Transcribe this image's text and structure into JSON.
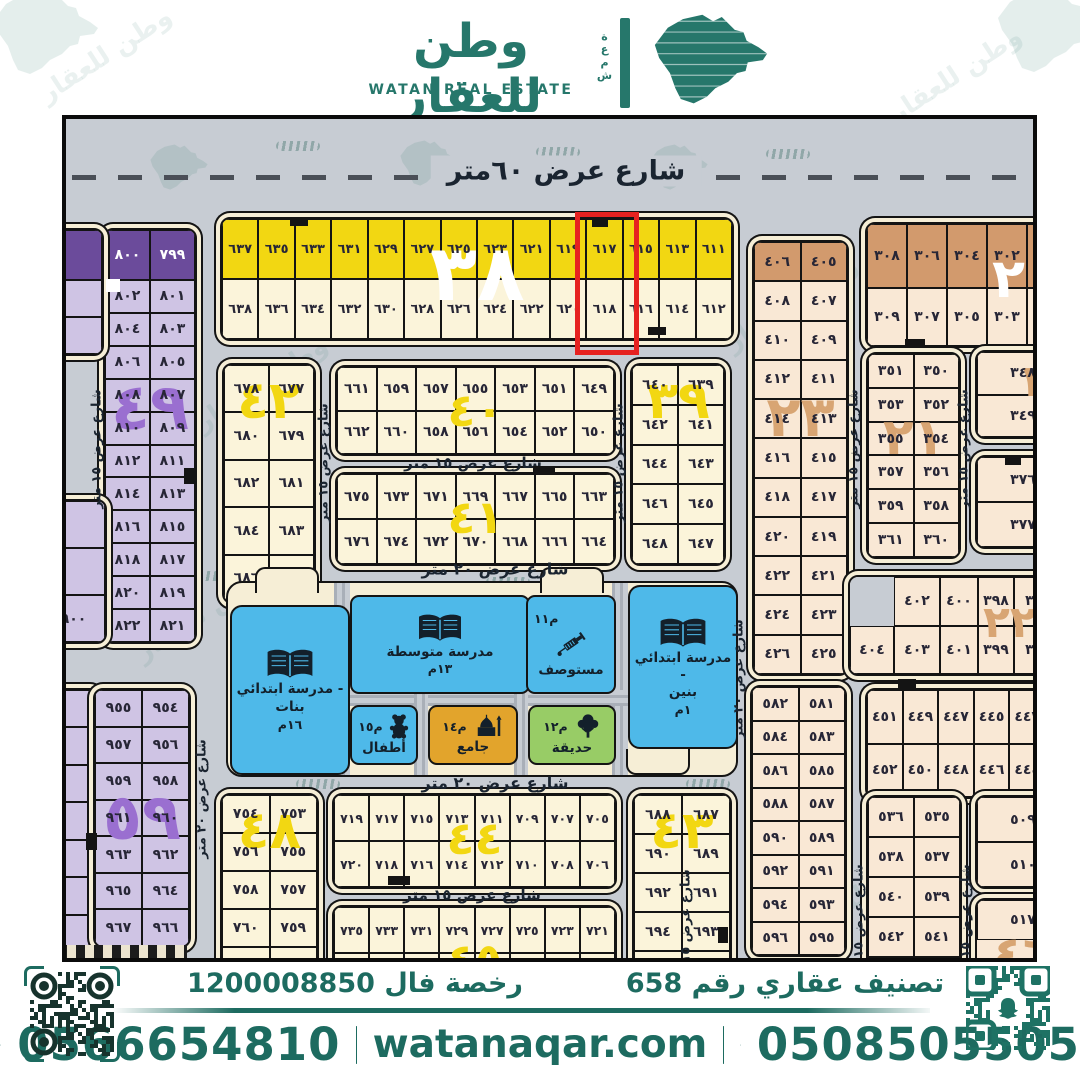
{
  "brand": {
    "name_ar": "وطن للعقار",
    "name_en": "WATAN REAL ESTATE",
    "side_ar": "شمعة",
    "watermark": "وطن للعقار",
    "accent": "#1d6b60"
  },
  "map": {
    "streets": {
      "sixty": "شارع عرض ٦٠متر",
      "twenty": "شارع عرض ٢٠ متر",
      "fifteen": "شارع عرض ١٥ متر"
    },
    "highlight_plots": [
      "٦١٧",
      "٦١٨"
    ],
    "highlight_color": "#e62220",
    "blocks": {
      "b38": {
        "num": "٣٨",
        "rows": [
          [
            "٦٣٧",
            "٦٣٥",
            "٦٣٣",
            "٦٣١",
            "٦٢٩",
            "٦٢٧",
            "٦٢٥",
            "٦٢٣",
            "٦٢١",
            "٦١٩",
            "٦١٧",
            "٦١٥",
            "٦١٣",
            "٦١١"
          ],
          [
            "٦٣٨",
            "٦٣٦",
            "٦٣٤",
            "٦٣٢",
            "٦٣٠",
            "٦٢٨",
            "٦٢٦",
            "٦٢٤",
            "٦٢٢",
            "٦٢٠",
            "٦١٨",
            "٦١٦",
            "٦١٤",
            "٦١٢"
          ]
        ]
      },
      "btr": {
        "num": "٢٠",
        "rows": [
          [
            "٣٠٨",
            "٣٠٦",
            "٣٠٤",
            "٣٠٢",
            "٣٠٠"
          ],
          [
            "٣٠٩",
            "٣٠٧",
            "٣٠٥",
            "٣٠٣",
            "٣٠١"
          ]
        ]
      },
      "b49": {
        "num": "٤٩",
        "rows": [
          [
            "٨٠٠",
            "٧٩٩"
          ],
          [
            "٨٠٢",
            "٨٠١"
          ],
          [
            "٨٠٤",
            "٨٠٣"
          ],
          [
            "٨٠٦",
            "٨٠٥"
          ],
          [
            "٨٠٨",
            "٨٠٧"
          ],
          [
            "٨١٠",
            "٨٠٩"
          ],
          [
            "٨١٢",
            "٨١١"
          ],
          [
            "٨١٤",
            "٨١٣"
          ],
          [
            "٨١٦",
            "٨١٥"
          ],
          [
            "٨١٨",
            "٨١٧"
          ],
          [
            "٨٢٠",
            "٨١٩"
          ],
          [
            "٨٢٢",
            "٨٢١"
          ]
        ]
      },
      "s1": {
        "rows": [
          [
            ""
          ],
          [
            ""
          ],
          [
            ""
          ]
        ]
      },
      "s2": {
        "rows": [
          [
            ""
          ],
          [
            ""
          ],
          [
            "٩٠٠"
          ]
        ]
      },
      "s3": {
        "rows": [
          [
            ""
          ],
          [
            ""
          ],
          [
            ""
          ],
          [
            ""
          ],
          [
            ""
          ],
          [
            ""
          ],
          [
            ""
          ]
        ]
      },
      "b42": {
        "num": "٤٢",
        "rows": [
          [
            "٦٧٨",
            "٦٧٧"
          ],
          [
            "٦٨٠",
            "٦٧٩"
          ],
          [
            "٦٨٢",
            "٦٨١"
          ],
          [
            "٦٨٤",
            "٦٨٣"
          ],
          [
            "٦٨٦",
            "٦٨٥"
          ]
        ]
      },
      "b40": {
        "num": "٤٠",
        "rows": [
          [
            "٦٦١",
            "٦٥٩",
            "٦٥٧",
            "٦٥٥",
            "٦٥٣",
            "٦٥١",
            "٦٤٩"
          ],
          [
            "٦٦٢",
            "٦٦٠",
            "٦٥٨",
            "٦٥٦",
            "٦٥٤",
            "٦٥٢",
            "٦٥٠"
          ]
        ]
      },
      "b41": {
        "num": "٤١",
        "rows": [
          [
            "٦٧٥",
            "٦٧٣",
            "٦٧١",
            "٦٦٩",
            "٦٦٧",
            "٦٦٥",
            "٦٦٣"
          ],
          [
            "٦٧٦",
            "٦٧٤",
            "٦٧٢",
            "٦٧٠",
            "٦٦٨",
            "٦٦٦",
            "٦٦٤"
          ]
        ]
      },
      "b39": {
        "num": "٣٩",
        "rows": [
          [
            "٦٤٠",
            "٦٣٩"
          ],
          [
            "٦٤٢",
            "٦٤١"
          ],
          [
            "٦٤٤",
            "٦٤٣"
          ],
          [
            "٦٤٦",
            "٦٤٥"
          ],
          [
            "٦٤٨",
            "٦٤٧"
          ]
        ]
      },
      "b23": {
        "num": "٢٣",
        "rows": [
          [
            "٤٠٦",
            "٤٠٥"
          ],
          [
            "٤٠٨",
            "٤٠٧"
          ],
          [
            "٤١٠",
            "٤٠٩"
          ],
          [
            "٤١٢",
            "٤١١"
          ],
          [
            "٤١٤",
            "٤١٣"
          ],
          [
            "٤١٦",
            "٤١٥"
          ],
          [
            "٤١٨",
            "٤١٧"
          ],
          [
            "٤٢٠",
            "٤١٩"
          ],
          [
            "٤٢٢",
            "٤٢١"
          ],
          [
            "٤٢٤",
            "٤٢٣"
          ],
          [
            "٤٢٦",
            "٤٢٥"
          ]
        ]
      },
      "b21": {
        "num": "٢١",
        "rows": [
          [
            "٣٥١",
            "٣٥٠"
          ],
          [
            "٣٥٣",
            "٣٥٢"
          ],
          [
            "٣٥٥",
            "٣٥٤"
          ],
          [
            "٣٥٧",
            "٣٥٦"
          ],
          [
            "٣٥٩",
            "٣٥٨"
          ],
          [
            "٣٦١",
            "٣٦٠"
          ]
        ]
      },
      "b19": {
        "num": "١٩",
        "rows": [
          [
            "٣٤٨"
          ],
          [
            "٣٤٩"
          ]
        ]
      },
      "b376": {
        "rows": [
          [
            "٣٧٦"
          ],
          [
            "٣٧٧"
          ]
        ]
      },
      "b22": {
        "num": "٢٢",
        "rows": [
          [
            null,
            "٤٠٢",
            "٤٠٠",
            "٣٩٨",
            "٣٩٦"
          ],
          [
            "٤٠٤",
            "٤٠٣",
            "٤٠١",
            "٣٩٩",
            "٣٩٧"
          ]
        ]
      },
      "b59": {
        "num": "٥٩",
        "rows": [
          [
            "٩٥٥",
            "٩٥٤"
          ],
          [
            "٩٥٧",
            "٩٥٦"
          ],
          [
            "٩٥٩",
            "٩٥٨"
          ],
          [
            "٩٦١",
            "٩٦٠"
          ],
          [
            "٩٦٣",
            "٩٦٢"
          ],
          [
            "٩٦٥",
            "٩٦٤"
          ],
          [
            "٩٦٧",
            "٩٦٦"
          ]
        ]
      },
      "b48": {
        "num": "٤٨",
        "rows": [
          [
            "٧٥٤",
            "٧٥٣"
          ],
          [
            "٧٥٦",
            "٧٥٥"
          ],
          [
            "٧٥٨",
            "٧٥٧"
          ],
          [
            "٧٦٠",
            "٧٥٩"
          ],
          [
            "",
            ""
          ]
        ]
      },
      "b44": {
        "num": "٤٤",
        "rows": [
          [
            "٧١٩",
            "٧١٧",
            "٧١٥",
            "٧١٣",
            "٧١١",
            "٧٠٩",
            "٧٠٧",
            "٧٠٥"
          ],
          [
            "٧٢٠",
            "٧١٨",
            "٧١٦",
            "٧١٤",
            "٧١٢",
            "٧١٠",
            "٧٠٨",
            "٧٠٦"
          ]
        ]
      },
      "b45": {
        "num": "٤٥",
        "rows": [
          [
            "٧٣٥",
            "٧٣٣",
            "٧٣١",
            "٧٢٩",
            "٧٢٧",
            "٧٢٥",
            "٧٢٣",
            "٧٢١"
          ],
          [
            "",
            "",
            "",
            "",
            "",
            "",
            "",
            ""
          ]
        ]
      },
      "b43": {
        "num": "٤٣",
        "rows": [
          [
            "٦٨٨",
            "٦٨٧"
          ],
          [
            "٦٩٠",
            "٦٨٩"
          ],
          [
            "٦٩٢",
            "٦٩١"
          ],
          [
            "٦٩٤",
            "٦٩٣"
          ],
          [
            "",
            ""
          ]
        ]
      },
      "b581": {
        "rows": [
          [
            "٥٨٢",
            "٥٨١"
          ],
          [
            "٥٨٤",
            "٥٨٣"
          ],
          [
            "٥٨٦",
            "٥٨٥"
          ],
          [
            "٥٨٨",
            "٥٨٧"
          ],
          [
            "٥٩٠",
            "٥٨٩"
          ],
          [
            "٥٩٢",
            "٥٩١"
          ],
          [
            "٥٩٤",
            "٥٩٣"
          ],
          [
            "٥٩٦",
            "٥٩٥"
          ]
        ]
      },
      "b444": {
        "rows": [
          [
            "٤٥١",
            "٤٤٩",
            "٤٤٧",
            "٤٤٥",
            "٤٤٣"
          ],
          [
            "٤٥٢",
            "٤٥٠",
            "٤٤٨",
            "٤٤٦",
            "٤٤٤"
          ]
        ]
      },
      "b535": {
        "rows": [
          [
            "٥٣٦",
            "٥٣٥"
          ],
          [
            "٥٣٨",
            "٥٣٧"
          ],
          [
            "٥٤٠",
            "٥٣٩"
          ],
          [
            "٥٤٢",
            "٥٤١"
          ],
          [
            "٥٤٤",
            "٥٤٣"
          ]
        ]
      },
      "b509": {
        "rows": [
          [
            "٥٠٩"
          ],
          [
            "٥١٠"
          ]
        ]
      },
      "b517": {
        "num": "٤٦",
        "rows": [
          [
            "٥١٧"
          ]
        ]
      }
    },
    "services": {
      "girls": {
        "line1": "مدرسة ابتدائي -",
        "line2": "بنات",
        "code": "١٦م"
      },
      "middle": {
        "name": "مدرسة متوسطة",
        "code": "١٣م"
      },
      "clinic": {
        "name": "مستوصف",
        "code": "م١١"
      },
      "boys": {
        "line1": "مدرسة ابتدائي -",
        "line2": "بنين",
        "code": "١م"
      },
      "kids": {
        "name": "أطفال",
        "code": "م١٥"
      },
      "mosque": {
        "name": "جامع",
        "code": "م١٤"
      },
      "garden": {
        "name": "حديقة",
        "code": "م١٢"
      }
    }
  },
  "footer": {
    "license": "رخصة فال 1200008850",
    "classification": "تصنيف عقاري رقم 658",
    "phone_left": "0566654810",
    "phone_right": "0508505505",
    "website": "watanaqar.com"
  }
}
